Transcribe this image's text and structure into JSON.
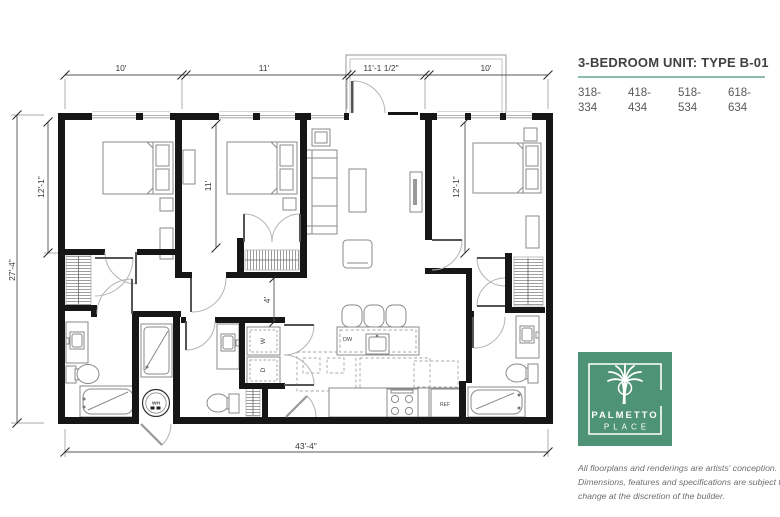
{
  "plan": {
    "dims": {
      "top_bed1": "10'",
      "top_bed2": "11'",
      "top_entry": "11'-1 1/2\"",
      "top_bed3": "10'",
      "side_total": "27'-4\"",
      "side_bed1": "12'-1\"",
      "bed2_depth": "11'",
      "bed3_depth": "12'-1\"",
      "hall_width": "4'",
      "bottom_total": "43'-4\""
    },
    "fixtures": {
      "dishwasher": "DW",
      "refrigerator": "REF",
      "washer": "W",
      "dryer": "D",
      "water_heater": "WH"
    }
  },
  "panel": {
    "title": "3-BEDROOM UNIT: TYPE B-01",
    "units": [
      {
        "from": "318-",
        "to": "334"
      },
      {
        "from": "418-",
        "to": "434"
      },
      {
        "from": "518-",
        "to": "534"
      },
      {
        "from": "618-",
        "to": "634"
      }
    ],
    "logo": {
      "line1": "PALMETTO",
      "line2": "PLACE"
    },
    "disclaimer": {
      "line1": "All floorplans and renderings are artists' conception.",
      "line2": "Dimensions, features and specifications are subject to",
      "line3": "change at the discretion of the builder."
    },
    "colors": {
      "accent_teal": "#8cbcaa",
      "logo_green": "#4f9377"
    }
  }
}
